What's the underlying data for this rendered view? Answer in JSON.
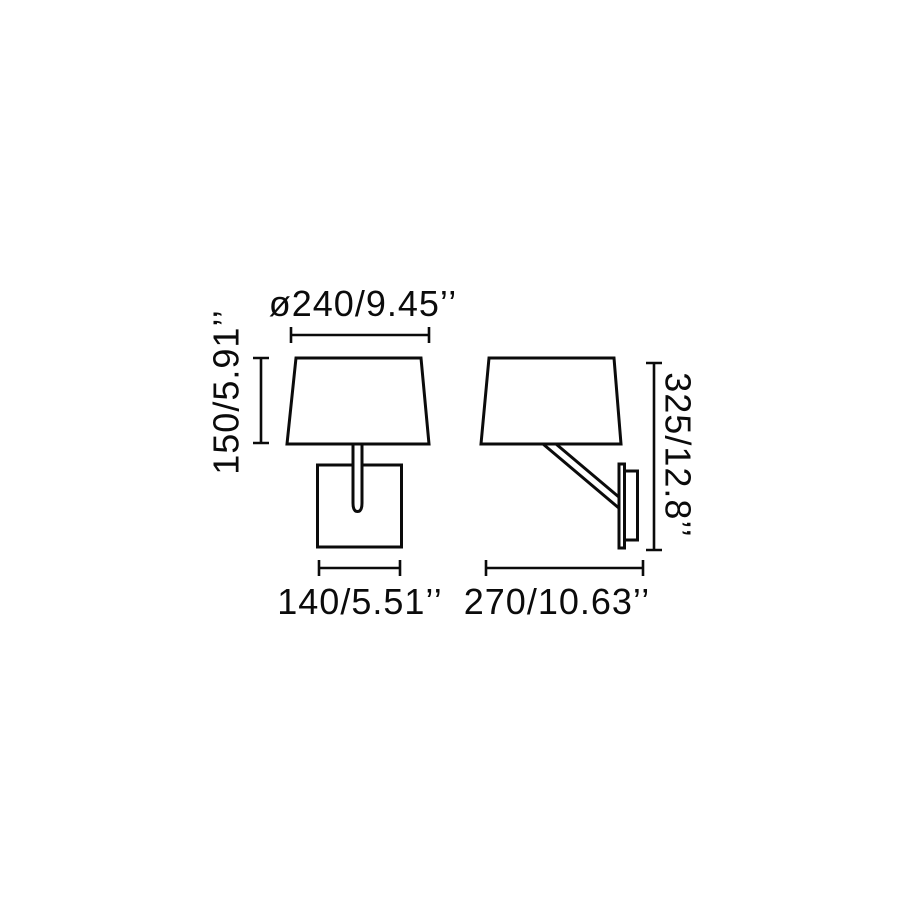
{
  "canvas": {
    "width_px": 900,
    "height_px": 900,
    "background": "#ffffff",
    "line_color": "#0b0b0b",
    "text_color": "#0b0b0b"
  },
  "drawing": {
    "kind": "wall-lamp dimension drawing, two views",
    "dimensions": {
      "shade_diameter": {
        "label": "ø240/9.45’’",
        "mm": "240",
        "inches": "9.45"
      },
      "shade_height": {
        "label": "150/5.91’’",
        "mm": "150",
        "inches": "5.91"
      },
      "backplate_width": {
        "label": "140/5.51’’",
        "mm": "140",
        "inches": "5.51"
      },
      "depth": {
        "label": "270/10.63’’",
        "mm": "270",
        "inches": "10.63"
      },
      "total_height": {
        "label": "325/12.8’’",
        "mm": "325",
        "inches": "12.8"
      }
    }
  }
}
